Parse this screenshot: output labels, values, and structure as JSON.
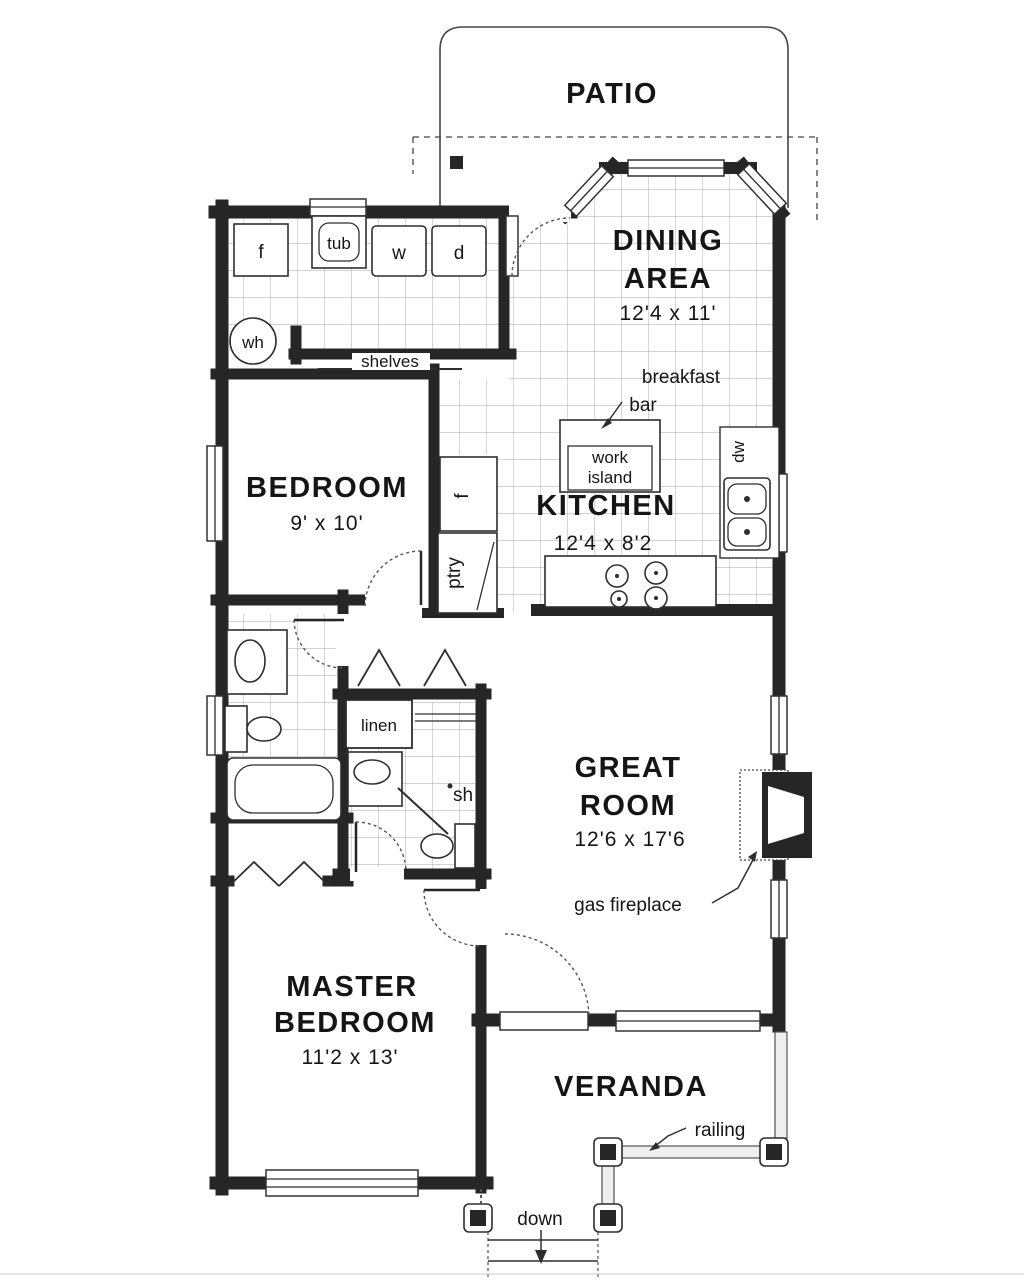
{
  "plan": {
    "rooms": {
      "patio": {
        "name": "PATIO"
      },
      "dining_area": {
        "line1": "DINING",
        "line2": "AREA",
        "dims": "12'4 x 11'"
      },
      "kitchen": {
        "name": "KITCHEN",
        "dims": "12'4 x 8'2"
      },
      "bedroom": {
        "name": "BEDROOM",
        "dims": "9' x 10'"
      },
      "great_room": {
        "line1": "GREAT",
        "line2": "ROOM",
        "dims": "12'6 x 17'6"
      },
      "master_bedroom": {
        "line1": "MASTER",
        "line2": "BEDROOM",
        "dims": "11'2 x 13'"
      },
      "veranda": {
        "name": "VERANDA"
      }
    },
    "annotations": {
      "freezer": "f",
      "laundry_tub": "tub",
      "washer": "w",
      "dryer": "d",
      "water_heater": "wh",
      "shelves": "shelves",
      "breakfast_bar_line1": "breakfast",
      "breakfast_bar_line2": "bar",
      "work_island_line1": "work",
      "work_island_line2": "island",
      "refrigerator": "f",
      "pantry": "ptry",
      "dishwasher": "dw",
      "linen": "linen",
      "shower": "sh",
      "gas_fireplace": "gas fireplace",
      "railing": "railing",
      "stairs": "down"
    },
    "colors": {
      "walls": "#262626",
      "tile_lines": "#a5a5a5",
      "background": "#ffffff",
      "thin_lines": "#3a3a3a"
    }
  }
}
